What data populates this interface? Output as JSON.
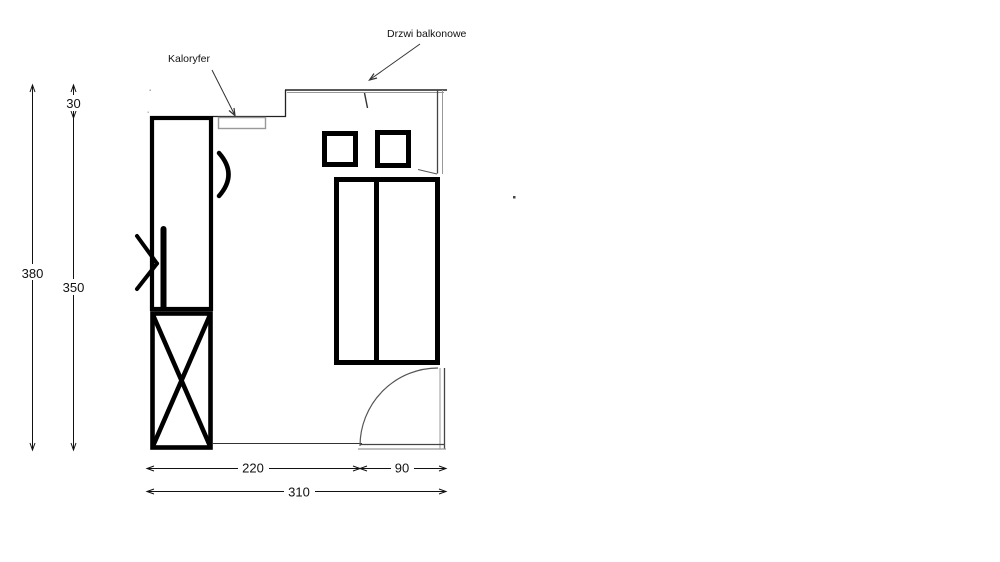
{
  "drawing": {
    "type": "room-floor-plan",
    "annotations": {
      "radiator_label": "Kaloryfer",
      "balcony_door_label": "Drzwi balkonowe"
    },
    "dimensions": {
      "overall_height": "380",
      "top_wall_offset": "30",
      "inner_height": "350",
      "bottom_width_left": "220",
      "bottom_width_right": "90",
      "overall_width": "310"
    },
    "colors": {
      "furniture_line": "#000000",
      "wall_dark": "#333333",
      "wall_gray": "#999999",
      "dimension_line": "#111111"
    }
  }
}
